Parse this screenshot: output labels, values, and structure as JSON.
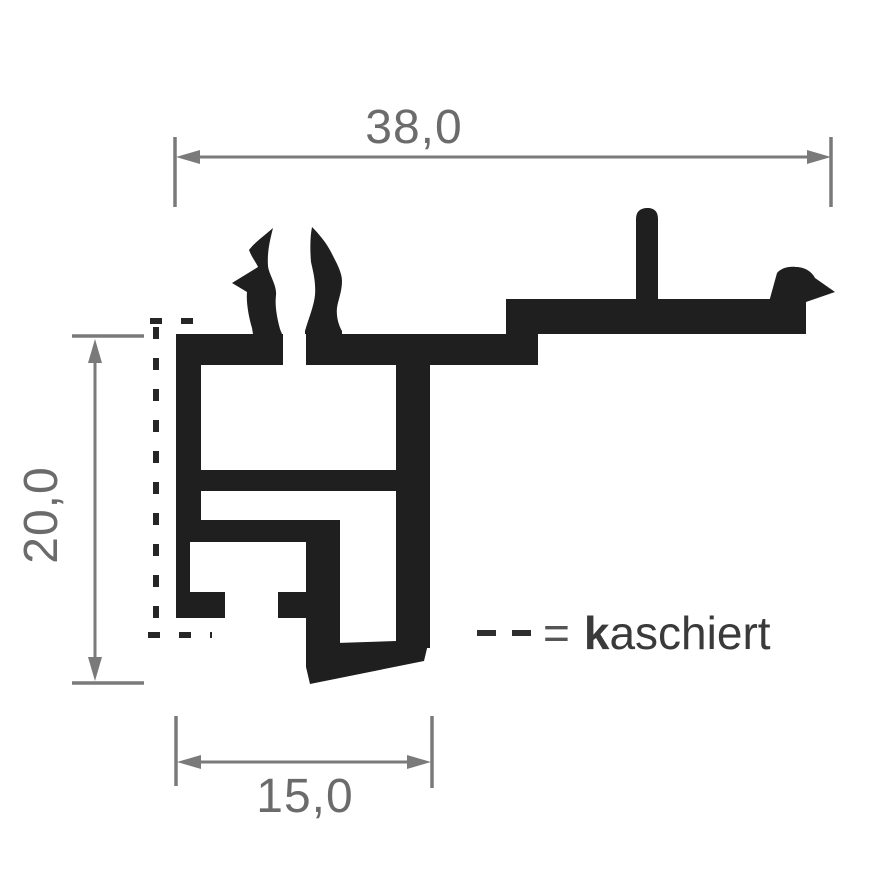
{
  "drawing": {
    "type": "profile-cross-section-technical-drawing",
    "dimensions": {
      "top_width": "38,0",
      "left_height": "20,0",
      "bottom_width": "15,0"
    },
    "legend": {
      "equals": "=",
      "term_bold": "k",
      "term_rest": "aschiert"
    },
    "colors": {
      "profile": "#1f1f1f",
      "dimension_lines": "#7a7a7a",
      "dimension_text": "#6b6b6b",
      "legend_text": "#3a3a3a",
      "dashed_marking": "#262626",
      "background": "#ffffff"
    }
  }
}
